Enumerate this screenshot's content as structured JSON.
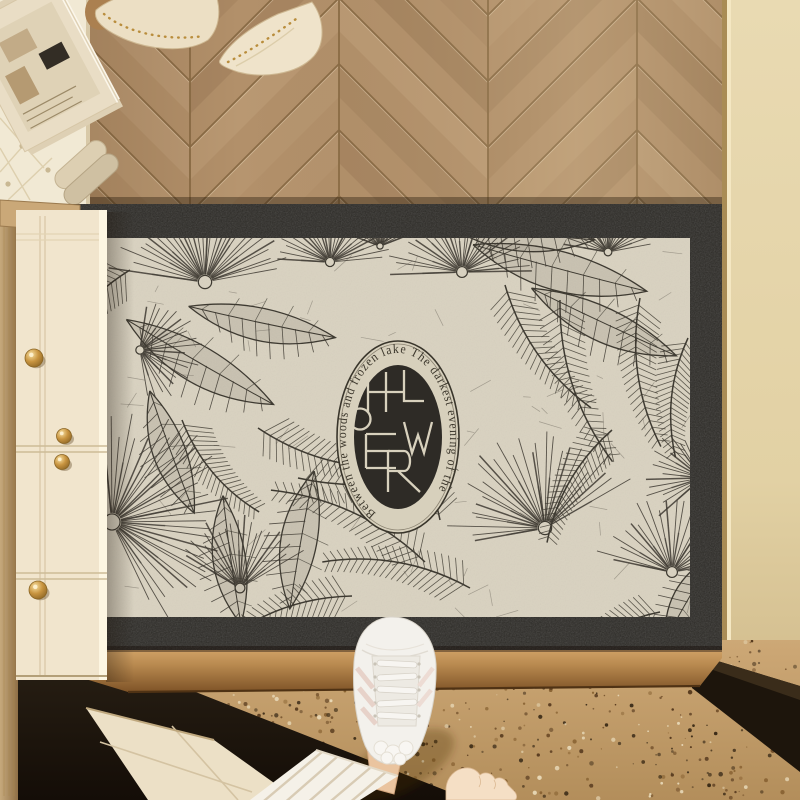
{
  "mat": {
    "ring_text": "Between the woods and frozen lake The darkest evening of the",
    "monogram": "HOLWER",
    "monogram_letters": [
      "H",
      "O",
      "L",
      "W",
      "E",
      "R"
    ]
  },
  "palette": {
    "ink": "#38342b",
    "mat_field": "#d9d2c0",
    "mat_border": "#2c2a26",
    "medallion_bg": "#2e2b26",
    "medallion_lines": "#d8d1bd",
    "ring_text_color": "#3c372c",
    "wood_base": "#ab8a60",
    "wood_seam": "#83653f",
    "wall": "#e6d6ac",
    "cabinet": "#f1e5cd",
    "knob_gold": "#c89440",
    "threshold_bronze": "#b08145",
    "terrazzo": "#c49c6a",
    "plinth_dark": "#221a10",
    "sneaker_white": "#f3f1ec",
    "skin": "#eac49f",
    "pants": "#f5f1e8",
    "bench": "#f1e9d4",
    "magazine": "#e9ddc5"
  }
}
